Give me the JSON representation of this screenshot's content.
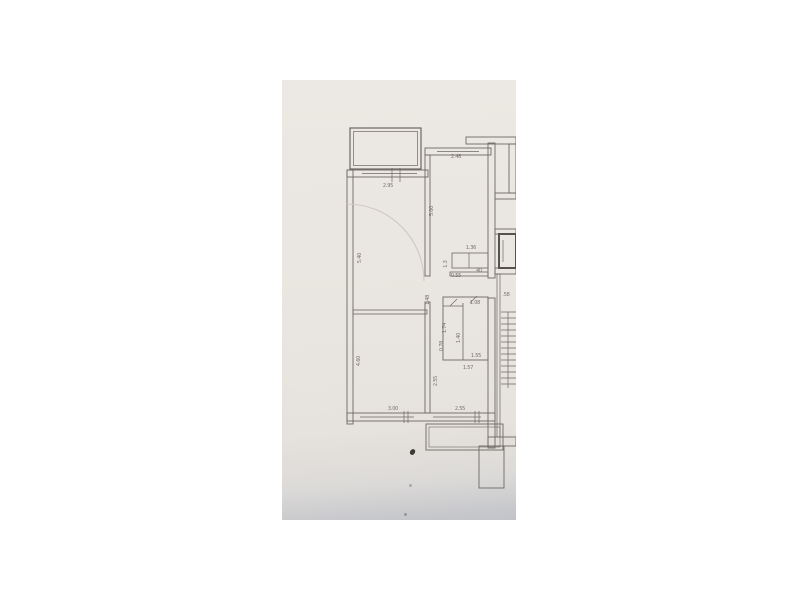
{
  "window": {
    "background_color": "#ffffff"
  },
  "photo": {
    "kind": "photograph-of-paper-floor-plan",
    "paper_color": "#e9e5e0",
    "bottom_tint_color": "#c2c4c9",
    "line_color": "#6e6862",
    "faint_line_color": "#cfc9c2"
  },
  "floorplan": {
    "dimension_labels": [
      {
        "text": "2.95",
        "x": 388,
        "y": 187,
        "rot": 0
      },
      {
        "text": "5.40",
        "x": 361,
        "y": 258,
        "rot": -90
      },
      {
        "text": "4.60",
        "x": 360,
        "y": 361,
        "rot": -90
      },
      {
        "text": "3.00",
        "x": 393,
        "y": 410,
        "rot": 0
      },
      {
        "text": "2.48",
        "x": 456,
        "y": 158,
        "rot": 0
      },
      {
        "text": "5.00",
        "x": 433,
        "y": 211,
        "rot": -90
      },
      {
        "text": "1.36",
        "x": 471,
        "y": 249,
        "rot": 0
      },
      {
        "text": "1.3",
        "x": 447,
        "y": 264,
        "rot": -90
      },
      {
        "text": "0.55",
        "x": 456,
        "y": 277,
        "rot": 0
      },
      {
        "text": "40",
        "x": 479,
        "y": 272,
        "rot": 0
      },
      {
        "text": "1.48",
        "x": 429,
        "y": 300,
        "rot": -90
      },
      {
        "text": ".58",
        "x": 506,
        "y": 296,
        "rot": 0
      },
      {
        "text": "1.08",
        "x": 475,
        "y": 304,
        "rot": 0
      },
      {
        "text": "1.74",
        "x": 446,
        "y": 328,
        "rot": -90
      },
      {
        "text": "1.40",
        "x": 460,
        "y": 338,
        "rot": -90
      },
      {
        "text": "0.78",
        "x": 443,
        "y": 346,
        "rot": -90
      },
      {
        "text": "1.55",
        "x": 476,
        "y": 357,
        "rot": 0
      },
      {
        "text": "1.57",
        "x": 468,
        "y": 369,
        "rot": 0
      },
      {
        "text": "2.55",
        "x": 437,
        "y": 381,
        "rot": -90
      },
      {
        "text": "2.55",
        "x": 460,
        "y": 410,
        "rot": 0
      }
    ]
  }
}
